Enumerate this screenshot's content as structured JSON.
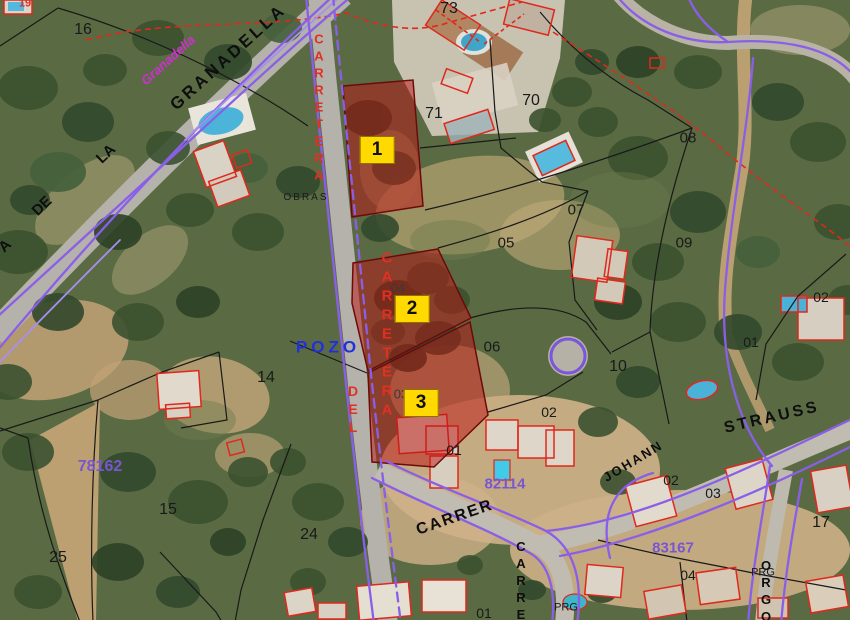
{
  "app": {
    "type": "cadastral-aerial-map-viewer"
  },
  "map": {
    "highlighted_parcels": [
      {
        "label": "1",
        "x": 377,
        "y": 150
      },
      {
        "label": "2",
        "x": 412,
        "y": 309
      },
      {
        "label": "3",
        "x": 421,
        "y": 403
      }
    ],
    "colors": {
      "highlight_fill": "#bb1111",
      "badge_bg": "#ffd900",
      "road_edge_purple": "#8a5fe8",
      "cadastral_red": "#e0281c",
      "zone_text_purple": "#7a55d2",
      "street_blue": "#2030dd",
      "street_magenta": "#cf2fd0"
    },
    "labels": [
      {
        "text": "GRANADELLA",
        "kind": "street",
        "x": 228,
        "y": 57,
        "size": 17,
        "rot": -42,
        "ls": 3
      },
      {
        "text": "DE",
        "kind": "street",
        "x": 42,
        "y": 206,
        "size": 15,
        "rot": -44
      },
      {
        "text": "LA",
        "kind": "street",
        "x": 106,
        "y": 154,
        "size": 15,
        "rot": -44
      },
      {
        "text": "A",
        "kind": "street",
        "x": 5,
        "y": 246,
        "size": 15,
        "rot": -44
      },
      {
        "text": "CARRER",
        "kind": "street",
        "x": 455,
        "y": 518,
        "size": 16,
        "rot": -19,
        "ls": 2
      },
      {
        "text": "JOHANN",
        "kind": "street",
        "x": 633,
        "y": 461,
        "size": 13,
        "rot": -31,
        "ls": 2
      },
      {
        "text": "STRAUSS",
        "kind": "street",
        "x": 772,
        "y": 418,
        "size": 16,
        "rot": -13,
        "ls": 3
      },
      {
        "text": "CARRER",
        "kind": "street",
        "x": 521,
        "y": 590,
        "size": 13,
        "vertical": true
      },
      {
        "text": "ORGO",
        "kind": "street",
        "x": 766,
        "y": 592,
        "size": 13,
        "vertical": true
      },
      {
        "text": "CARRETERA",
        "kind": "street-red",
        "x": 319,
        "y": 108,
        "size": 13,
        "vertical": true
      },
      {
        "text": "CARRETERA",
        "kind": "street-red",
        "x": 387,
        "y": 335,
        "size": 15,
        "vertical": true
      },
      {
        "text": "DEL",
        "kind": "street-red",
        "x": 353,
        "y": 410,
        "size": 14,
        "vertical": true
      },
      {
        "text": "POZO",
        "kind": "street-blue",
        "x": 328,
        "y": 347,
        "size": 17,
        "ls": 4
      },
      {
        "text": "Granadella",
        "kind": "magenta",
        "x": 168,
        "y": 60,
        "size": 13,
        "rot": -42
      },
      {
        "text": "78162",
        "kind": "zone",
        "x": 100,
        "y": 467,
        "size": 16
      },
      {
        "text": "82114",
        "kind": "zone",
        "x": 505,
        "y": 484,
        "size": 15
      },
      {
        "text": "83167",
        "kind": "zone",
        "x": 673,
        "y": 548,
        "size": 15
      },
      {
        "text": "16",
        "kind": "parcel-num",
        "x": 83,
        "y": 30,
        "size": 16
      },
      {
        "text": "73",
        "kind": "parcel-num",
        "x": 449,
        "y": 9,
        "size": 16
      },
      {
        "text": "71",
        "kind": "parcel-num",
        "x": 434,
        "y": 114,
        "size": 16
      },
      {
        "text": "70",
        "kind": "parcel-num",
        "x": 531,
        "y": 101,
        "size": 16
      },
      {
        "text": "08",
        "kind": "parcel-num",
        "x": 688,
        "y": 138,
        "size": 15
      },
      {
        "text": "07",
        "kind": "parcel-num",
        "x": 576,
        "y": 210,
        "size": 15
      },
      {
        "text": "05",
        "kind": "parcel-num",
        "x": 506,
        "y": 243,
        "size": 15
      },
      {
        "text": "09",
        "kind": "parcel-num",
        "x": 684,
        "y": 243,
        "size": 15
      },
      {
        "text": "04",
        "kind": "parcel-faint",
        "x": 398,
        "y": 288,
        "size": 13
      },
      {
        "text": "02",
        "kind": "parcel-num",
        "x": 821,
        "y": 297,
        "size": 14
      },
      {
        "text": "01",
        "kind": "parcel-num",
        "x": 751,
        "y": 342,
        "size": 14
      },
      {
        "text": "06",
        "kind": "parcel-num",
        "x": 492,
        "y": 347,
        "size": 15
      },
      {
        "text": "10",
        "kind": "parcel-num",
        "x": 618,
        "y": 367,
        "size": 16
      },
      {
        "text": "14",
        "kind": "parcel-num",
        "x": 266,
        "y": 378,
        "size": 16
      },
      {
        "text": "02",
        "kind": "parcel-num",
        "x": 549,
        "y": 412,
        "size": 14
      },
      {
        "text": "03",
        "kind": "parcel-faint",
        "x": 401,
        "y": 394,
        "size": 13
      },
      {
        "text": "01",
        "kind": "parcel-num",
        "x": 454,
        "y": 450,
        "size": 14
      },
      {
        "text": "15",
        "kind": "parcel-num",
        "x": 168,
        "y": 510,
        "size": 16
      },
      {
        "text": "17",
        "kind": "parcel-num",
        "x": 821,
        "y": 523,
        "size": 16
      },
      {
        "text": "02",
        "kind": "parcel-num",
        "x": 671,
        "y": 480,
        "size": 14
      },
      {
        "text": "03",
        "kind": "parcel-num",
        "x": 713,
        "y": 493,
        "size": 14
      },
      {
        "text": "24",
        "kind": "parcel-num",
        "x": 309,
        "y": 535,
        "size": 16
      },
      {
        "text": "25",
        "kind": "parcel-num",
        "x": 58,
        "y": 558,
        "size": 16
      },
      {
        "text": "04",
        "kind": "parcel-num",
        "x": 688,
        "y": 575,
        "size": 14
      },
      {
        "text": "01",
        "kind": "parcel-num",
        "x": 484,
        "y": 613,
        "size": 14
      },
      {
        "text": "OBRAS",
        "kind": "note",
        "x": 306,
        "y": 198,
        "size": 10,
        "ls": 2
      },
      {
        "text": "PRG",
        "kind": "note",
        "x": 763,
        "y": 573,
        "size": 11
      },
      {
        "text": "PRG",
        "kind": "note",
        "x": 566,
        "y": 608,
        "size": 11
      },
      {
        "text": "19",
        "kind": "red-num",
        "x": 25,
        "y": 4,
        "size": 11
      }
    ]
  }
}
